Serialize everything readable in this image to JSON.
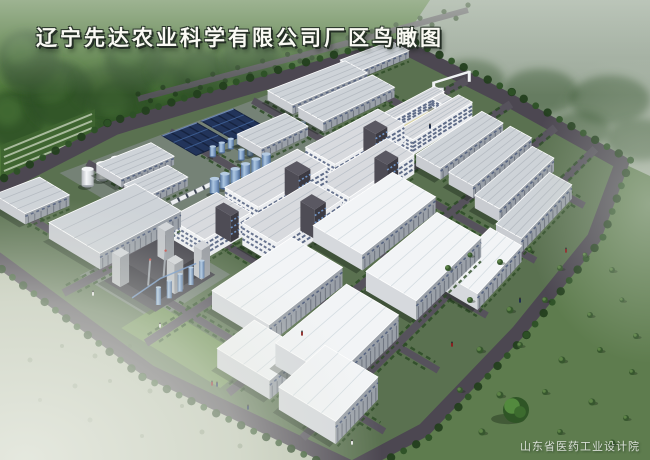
{
  "title": {
    "text": "辽宁先达农业科学有限公司厂区鸟瞰图"
  },
  "watermark": {
    "text": "山东省医药工业设计院"
  },
  "palette": {
    "bg_top": "#8f9e90",
    "bg_mid": "#aab4a3",
    "bg_low": "#c6ccbd",
    "lush_green": "#4d7639",
    "tree_dark": "#233f1e",
    "tree_mid": "#2d5126",
    "tree_lite": "#4a7439",
    "field_right": "#5e7c4e",
    "field_left_pale": "#bcc4b0",
    "fog": "#e7eae1",
    "road": "#56525c",
    "road_dark": "#4c4751",
    "park_base": "#5a7150",
    "lawn": "#6f9154",
    "hedge": "#2d4b26",
    "apron": "#8f949b",
    "roof_white": "#f2f4f6",
    "roof_gray": "#ced3d8",
    "wall_end": "#c9ccd1",
    "wall_long": "#9aa0a8",
    "wall_stripe": "#646a76",
    "window_band": "#475677",
    "ms_wall": "#e9ebee",
    "dark_struct": "#45444c",
    "tower_gray": "#c2c5c9",
    "solar": "#22345a",
    "solar_line": "#3c5c90",
    "tank_blue": "#7d9cc4",
    "tank_white": "#dfe3e6",
    "courtyard": "#d9d2a2",
    "shadow": "rgba(22,32,20,0.38)"
  },
  "scene": {
    "quad": {
      "o": [
        -60,
        218
      ],
      "t": [
        400,
        45
      ],
      "r": [
        622,
        163
      ],
      "b": [
        352,
        468
      ]
    },
    "boundary": [
      [
        -60,
        218
      ],
      [
        0,
        187
      ],
      [
        115,
        128
      ],
      [
        240,
        90
      ],
      [
        400,
        45
      ],
      [
        505,
        98
      ],
      [
        622,
        163
      ],
      [
        594,
        238
      ],
      [
        518,
        332
      ],
      [
        424,
        430
      ],
      [
        352,
        468
      ],
      [
        150,
        372
      ],
      [
        0,
        261
      ]
    ],
    "centroid": [
      320,
      262
    ],
    "roads_u": [
      0.12,
      0.32,
      0.5,
      0.68,
      0.86
    ],
    "roads_v": [
      0.3,
      0.5,
      0.7,
      0.88
    ],
    "ext_road": [
      [
        138,
        99
      ],
      [
        300,
        56
      ],
      [
        468,
        10
      ]
    ],
    "greenhouses": {
      "x0": 4,
      "y0": 150,
      "x1": 92,
      "y1": 114,
      "rows": 7,
      "step": 7
    },
    "lawn_patch": {
      "u": 0.0,
      "v": 0.44,
      "du": 0.1,
      "dv": 0.24
    },
    "aprons": [
      {
        "u": 0.26,
        "v": 0.0,
        "du": 0.46,
        "dv": 0.28
      },
      {
        "u": 0.06,
        "v": 0.28,
        "du": 0.2,
        "dv": 0.19
      }
    ],
    "solar_arrays": [
      {
        "u": 0.48,
        "v": 0.005,
        "du": 0.075,
        "dv": 0.105
      },
      {
        "u": 0.565,
        "v": 0.005,
        "du": 0.07,
        "dv": 0.105
      }
    ],
    "tank_rows": [
      {
        "color": "blue",
        "v": 0.135,
        "u0": 0.5,
        "u1": 0.645,
        "n": 8,
        "r": 4,
        "h": 10
      },
      {
        "color": "blue",
        "v": 0.185,
        "u0": 0.53,
        "u1": 0.675,
        "n": 8,
        "r": 4,
        "h": 10
      },
      {
        "color": "blue",
        "v": 0.245,
        "u0": 0.42,
        "u1": 0.545,
        "n": 6,
        "r": 5.5,
        "h": 13
      },
      {
        "color": "white",
        "v": 0.065,
        "u0": 0.27,
        "u1": 0.335,
        "n": 3,
        "r": 7,
        "h": 15
      },
      {
        "color": "blue",
        "v": 0.3,
        "u0": 0.46,
        "u1": 0.52,
        "n": 3,
        "r": 4,
        "h": 9
      }
    ],
    "trucks": {
      "v": 0.215,
      "u0": 0.35,
      "u1": 0.45,
      "n": 6
    },
    "buildings": [
      {
        "type": "warehouse",
        "u": 0.1,
        "v": 0.02,
        "du": 0.1,
        "dv": 0.08,
        "h": 9
      },
      {
        "type": "warehouse",
        "u": 0.7,
        "v": 0.02,
        "du": 0.17,
        "dv": 0.09,
        "h": 11
      },
      {
        "type": "warehouse",
        "u": 0.87,
        "v": 0.0,
        "du": 0.11,
        "dv": 0.08,
        "h": 10
      },
      {
        "type": "warehouse",
        "u": 0.7,
        "v": 0.13,
        "du": 0.17,
        "dv": 0.09,
        "h": 11
      },
      {
        "type": "warehouse",
        "u": 0.56,
        "v": 0.13,
        "du": 0.11,
        "dv": 0.08,
        "h": 10
      },
      {
        "type": "warehouse",
        "u": 0.31,
        "v": 0.04,
        "du": 0.12,
        "dv": 0.07,
        "h": 8
      },
      {
        "type": "warehouse",
        "u": 0.3,
        "v": 0.13,
        "du": 0.1,
        "dv": 0.06,
        "h": 8
      },
      {
        "type": "warehouse",
        "u": 0.1,
        "v": 0.16,
        "du": 0.2,
        "dv": 0.13,
        "h": 12
      },
      {
        "type": "admin",
        "u": 0.76,
        "v": 0.3,
        "du": 0.16,
        "dv": 0.16,
        "h": 16
      },
      {
        "type": "gate",
        "u": 0.93,
        "v": 0.28,
        "du": 0.07,
        "dv": 0.08,
        "h": 10
      },
      {
        "type": "warehouse",
        "u": 0.74,
        "v": 0.5,
        "du": 0.18,
        "dv": 0.09,
        "h": 11
      },
      {
        "type": "warehouse",
        "u": 0.74,
        "v": 0.62,
        "du": 0.18,
        "dv": 0.09,
        "h": 11
      },
      {
        "type": "warehouse",
        "u": 0.72,
        "v": 0.74,
        "du": 0.18,
        "dv": 0.09,
        "h": 11
      },
      {
        "type": "warehouse",
        "u": 0.68,
        "v": 0.86,
        "du": 0.18,
        "dv": 0.09,
        "h": 11
      },
      {
        "type": "multistory",
        "u": 0.4,
        "v": 0.3,
        "du": 0.18,
        "dv": 0.1,
        "h": 17
      },
      {
        "type": "multistory",
        "u": 0.6,
        "v": 0.3,
        "du": 0.18,
        "dv": 0.1,
        "h": 17
      },
      {
        "type": "multistory",
        "u": 0.26,
        "v": 0.3,
        "du": 0.12,
        "dv": 0.1,
        "h": 15
      },
      {
        "type": "multistory",
        "u": 0.34,
        "v": 0.42,
        "du": 0.18,
        "dv": 0.1,
        "h": 17
      },
      {
        "type": "multistory",
        "u": 0.54,
        "v": 0.42,
        "du": 0.18,
        "dv": 0.1,
        "h": 17
      },
      {
        "type": "plant",
        "u": 0.08,
        "v": 0.32,
        "du": 0.16,
        "dv": 0.13,
        "h": 20
      },
      {
        "type": "warehouse-white",
        "u": 0.44,
        "v": 0.52,
        "du": 0.22,
        "dv": 0.15,
        "h": 12
      },
      {
        "type": "warehouse-white",
        "u": 0.16,
        "v": 0.52,
        "du": 0.22,
        "dv": 0.15,
        "h": 12
      },
      {
        "type": "warehouse-white",
        "u": 0.4,
        "v": 0.72,
        "du": 0.22,
        "dv": 0.15,
        "h": 13
      },
      {
        "type": "warehouse-white",
        "u": 0.12,
        "v": 0.72,
        "du": 0.22,
        "dv": 0.15,
        "h": 13
      },
      {
        "type": "warehouse-white",
        "u": 0.04,
        "v": 0.64,
        "du": 0.11,
        "dv": 0.13,
        "h": 11
      },
      {
        "type": "warehouse-white",
        "u": 0.03,
        "v": 0.8,
        "du": 0.15,
        "dv": 0.14,
        "h": 12
      },
      {
        "type": "warehouse-white",
        "u": 0.5,
        "v": 0.86,
        "du": 0.16,
        "dv": 0.11,
        "h": 11
      }
    ],
    "bushes_right": [
      [
        448,
        268,
        3
      ],
      [
        470,
        255,
        2.5
      ],
      [
        500,
        262,
        3
      ],
      [
        530,
        250,
        2.5
      ],
      [
        560,
        268,
        3
      ],
      [
        585,
        255,
        2.5
      ],
      [
        612,
        270,
        3
      ],
      [
        470,
        300,
        3
      ],
      [
        510,
        310,
        3.5
      ],
      [
        545,
        300,
        3
      ],
      [
        590,
        315,
        3
      ],
      [
        622,
        300,
        2.5
      ],
      [
        480,
        350,
        3.5
      ],
      [
        520,
        345,
        3
      ],
      [
        562,
        360,
        3.5
      ],
      [
        600,
        350,
        3
      ],
      [
        632,
        372,
        3
      ],
      [
        460,
        390,
        3
      ],
      [
        500,
        395,
        3.5
      ],
      [
        545,
        392,
        3
      ],
      [
        592,
        402,
        3.5
      ],
      [
        626,
        418,
        3
      ],
      [
        482,
        432,
        3.5
      ],
      [
        560,
        432,
        3
      ],
      [
        612,
        443,
        3.5
      ],
      [
        636,
        336,
        3
      ]
    ],
    "bushes_left": [
      [
        30,
        360,
        2.5
      ],
      [
        62,
        346,
        2
      ],
      [
        95,
        356,
        2.5
      ],
      [
        130,
        346,
        2
      ],
      [
        75,
        386,
        2.5
      ],
      [
        110,
        381,
        2
      ],
      [
        40,
        400,
        2
      ],
      [
        150,
        391,
        2.5
      ],
      [
        182,
        406,
        2
      ],
      [
        90,
        420,
        2.5
      ],
      [
        202,
        432,
        2.5
      ],
      [
        142,
        436,
        2
      ],
      [
        240,
        446,
        2.5
      ]
    ],
    "landmark_tree": [
      516,
      410,
      13
    ],
    "haze_trees_top": [
      [
        40,
        78,
        34
      ],
      [
        110,
        88,
        38
      ],
      [
        185,
        70,
        36
      ],
      [
        255,
        62,
        32
      ],
      [
        330,
        55,
        30
      ],
      [
        405,
        62,
        30
      ],
      [
        470,
        80,
        34
      ],
      [
        540,
        92,
        38
      ],
      [
        610,
        100,
        40
      ],
      [
        640,
        140,
        34
      ],
      [
        580,
        130,
        30
      ]
    ],
    "people": [
      [
        212,
        385
      ],
      [
        217,
        386
      ],
      [
        160,
        327
      ],
      [
        302,
        335
      ],
      [
        248,
        409
      ],
      [
        352,
        444
      ],
      [
        452,
        346
      ],
      [
        520,
        302
      ],
      [
        93,
        295
      ],
      [
        566,
        252
      ],
      [
        430,
        128
      ]
    ]
  }
}
